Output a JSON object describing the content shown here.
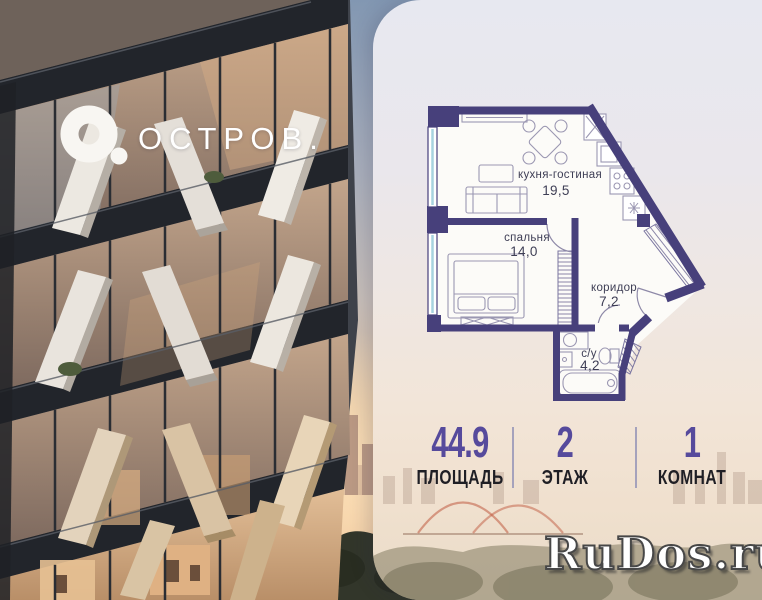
{
  "brand": {
    "name": "ОСТРОВ.",
    "logo_icon": "donut-o-icon",
    "logo_color": "#ffffff"
  },
  "floorplan": {
    "rooms": [
      {
        "name": "кухня-гостиная",
        "area": "19,5"
      },
      {
        "name": "спальня",
        "area": "14,0"
      },
      {
        "name": "коридор",
        "area": "7,2"
      },
      {
        "name": "с/у",
        "area": "4,2"
      }
    ],
    "wall_color": "#47407B"
  },
  "stats": {
    "items": [
      {
        "value": "44.9",
        "label": "ПЛОЩАДЬ"
      },
      {
        "value": "2",
        "label": "ЭТАЖ"
      },
      {
        "value": "1",
        "label": "КОМНАТ"
      }
    ],
    "value_color": "#564A9C",
    "label_color": "#1F1F25"
  },
  "watermark": {
    "text": "RuDos.ru"
  }
}
